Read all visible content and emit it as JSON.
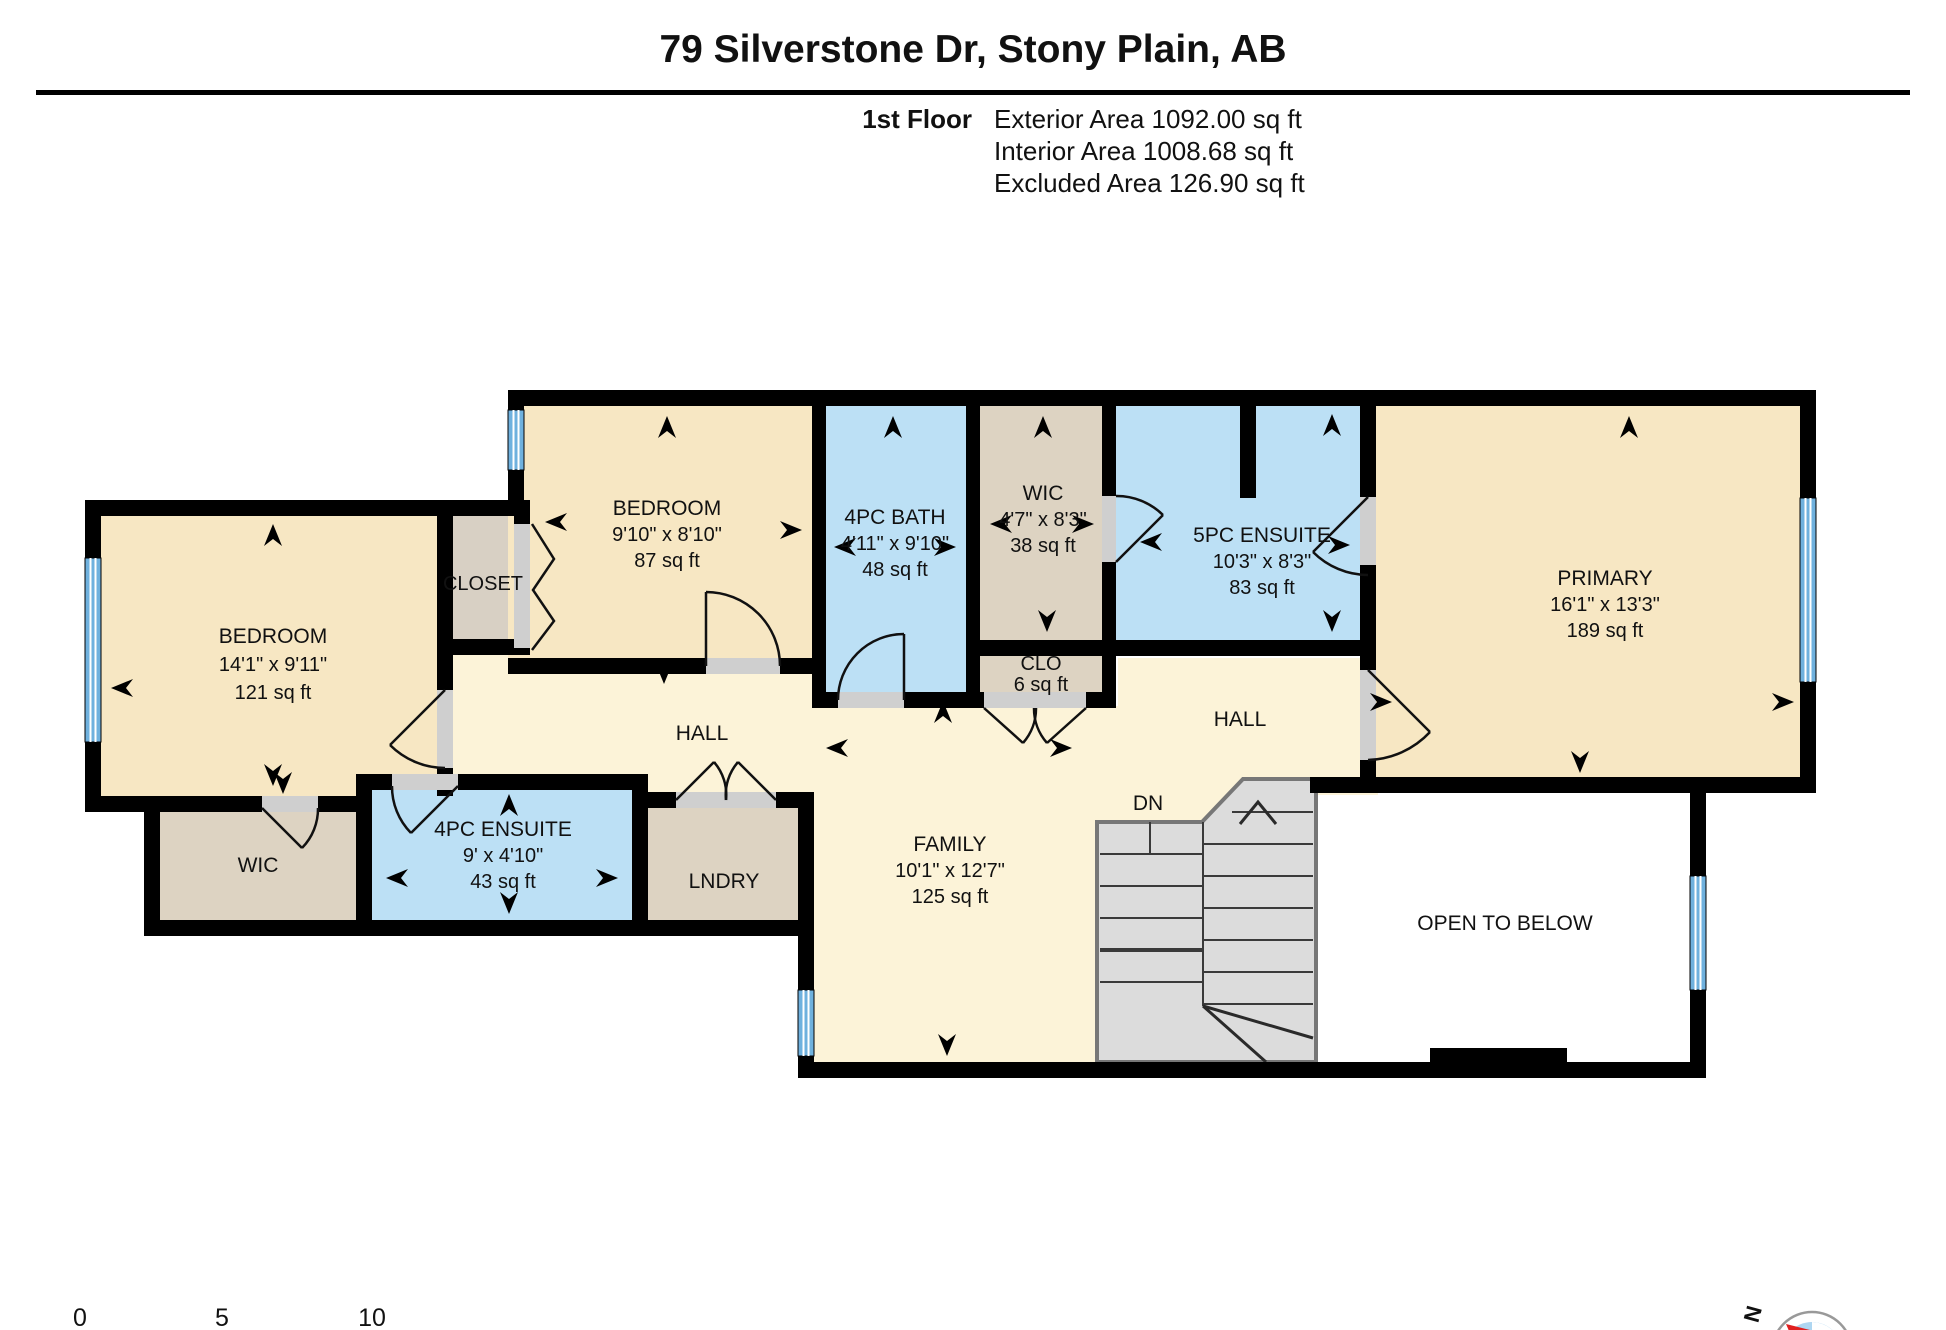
{
  "header": {
    "title": "79 Silverstone Dr, Stony Plain, AB",
    "floor_label": "1st Floor",
    "stats": [
      "Exterior Area 1092.00 sq ft",
      "Interior Area 1008.68 sq ft",
      "Excluded Area 126.90 sq ft"
    ]
  },
  "rooms": {
    "bedroom_left": {
      "name": "BEDROOM",
      "dims": "14'1\" x 9'11\"",
      "area": "121 sq ft"
    },
    "closet": {
      "name": "CLOSET"
    },
    "bedroom_2": {
      "name": "BEDROOM",
      "dims": "9'10\" x 8'10\"",
      "area": "87 sq ft"
    },
    "bath_4pc": {
      "name": "4PC BATH",
      "dims": "4'11\" x 9'10\"",
      "area": "48 sq ft"
    },
    "wic_top": {
      "name": "WIC",
      "dims": "4'7\" x 8'3\"",
      "area": "38 sq ft"
    },
    "ensuite_5pc": {
      "name": "5PC ENSUITE",
      "dims": "10'3\" x 8'3\"",
      "area": "83 sq ft"
    },
    "primary": {
      "name": "PRIMARY",
      "dims": "16'1\" x 13'3\"",
      "area": "189 sq ft"
    },
    "clo": {
      "name": "CLO",
      "area": "6 sq ft"
    },
    "hall_left": {
      "name": "HALL"
    },
    "hall_right": {
      "name": "HALL"
    },
    "wic_bottom": {
      "name": "WIC"
    },
    "ensuite_4pc": {
      "name": "4PC ENSUITE",
      "dims": "9' x 4'10\"",
      "area": "43 sq ft"
    },
    "laundry": {
      "name": "LNDRY"
    },
    "family": {
      "name": "FAMILY",
      "dims": "10'1\" x 12'7\"",
      "area": "125 sq ft"
    },
    "stairs": {
      "label": "DN"
    },
    "open_to_below": {
      "label": "OPEN TO BELOW"
    }
  },
  "scale_bar": {
    "ticks": [
      "0",
      "5",
      "10"
    ]
  },
  "compass": {
    "north": "N"
  },
  "colors": {
    "room_cream": "#f7e7c3",
    "open_cream": "#fcf3d8",
    "wet_blue": "#bce0f5",
    "tan": "#ddd3c2",
    "closet_grey": "#d8d0c4",
    "window_blue": "#6fb1de",
    "wall_black": "#000000",
    "stair_grey": "#dcdcdc",
    "compass_blue": "#aed6f1",
    "compass_red": "#e02020"
  }
}
